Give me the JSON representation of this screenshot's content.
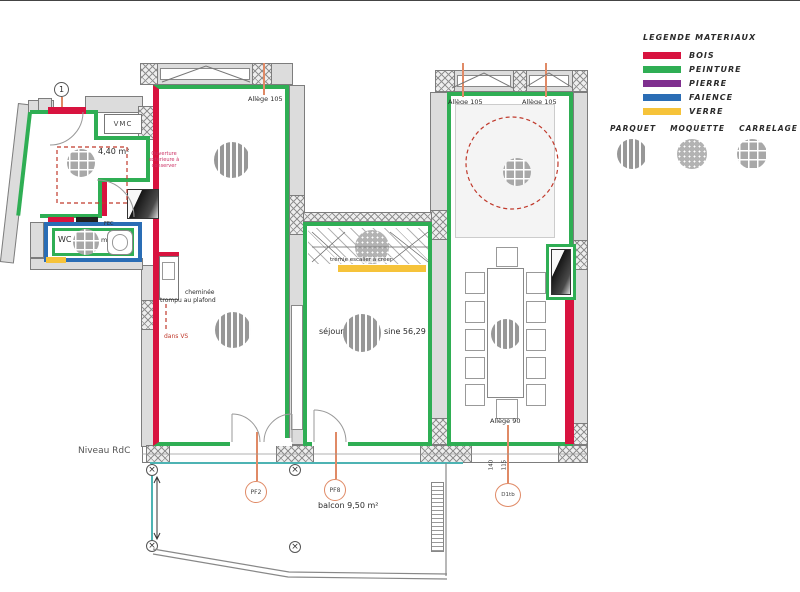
{
  "legend": {
    "title": "LEGENDE MATERIAUX",
    "materials": [
      {
        "label": "BOIS",
        "color": "#d8133f"
      },
      {
        "label": "PEINTURE",
        "color": "#2fae54"
      },
      {
        "label": "PIERRE",
        "color": "#7f2f8f"
      },
      {
        "label": "FAIENCE",
        "color": "#2a6db5"
      },
      {
        "label": "VERRE",
        "color": "#f6c33a"
      }
    ],
    "floorings": [
      {
        "label": "PARQUET",
        "pattern": "stripes"
      },
      {
        "label": "MOQUETTE",
        "pattern": "dots"
      },
      {
        "label": "CARRELAGE",
        "pattern": "grid"
      }
    ]
  },
  "plan": {
    "level_label": "Niveau RdC",
    "marker": "1",
    "entry": {
      "vmc_label": "VMC",
      "area_label": "4,40 m²",
      "door_tag": "FEC",
      "red_note_lines": [
        "Ouverture",
        "extérieure à",
        "conserver"
      ],
      "wc_label": "WC",
      "wc_area_label": "m²"
    },
    "left_room": {
      "allege_label": "Allège 105",
      "chimney_note_line1": "cheminée",
      "chimney_note_line2": "trompu au plafond",
      "chimney_red_note": "dans VS"
    },
    "middle_room": {
      "stair_note": "trémie escalier à créer",
      "name_label": "séjour",
      "area_label": "sine 56,29"
    },
    "right_room": {
      "allege_top_left": "Allège 105",
      "allege_top_right": "Allège 105",
      "allege_bottom": "Allège 90"
    },
    "balcony": {
      "area_label": "balcon 9,50 m²",
      "window_tag_1": "PF2",
      "window_tag_2": "PF8",
      "door_tag": "D1tb",
      "dim_1": "140",
      "dim_2": "115"
    }
  },
  "colors": {
    "bois": "#d8133f",
    "peinture": "#2fae54",
    "pierre": "#7f2f8f",
    "faience": "#2a6db5",
    "verre": "#f6c33a",
    "leader_lines": "#e08a66",
    "balcony_line": "#4db3b3",
    "dashed_marks": "#c0392b"
  }
}
